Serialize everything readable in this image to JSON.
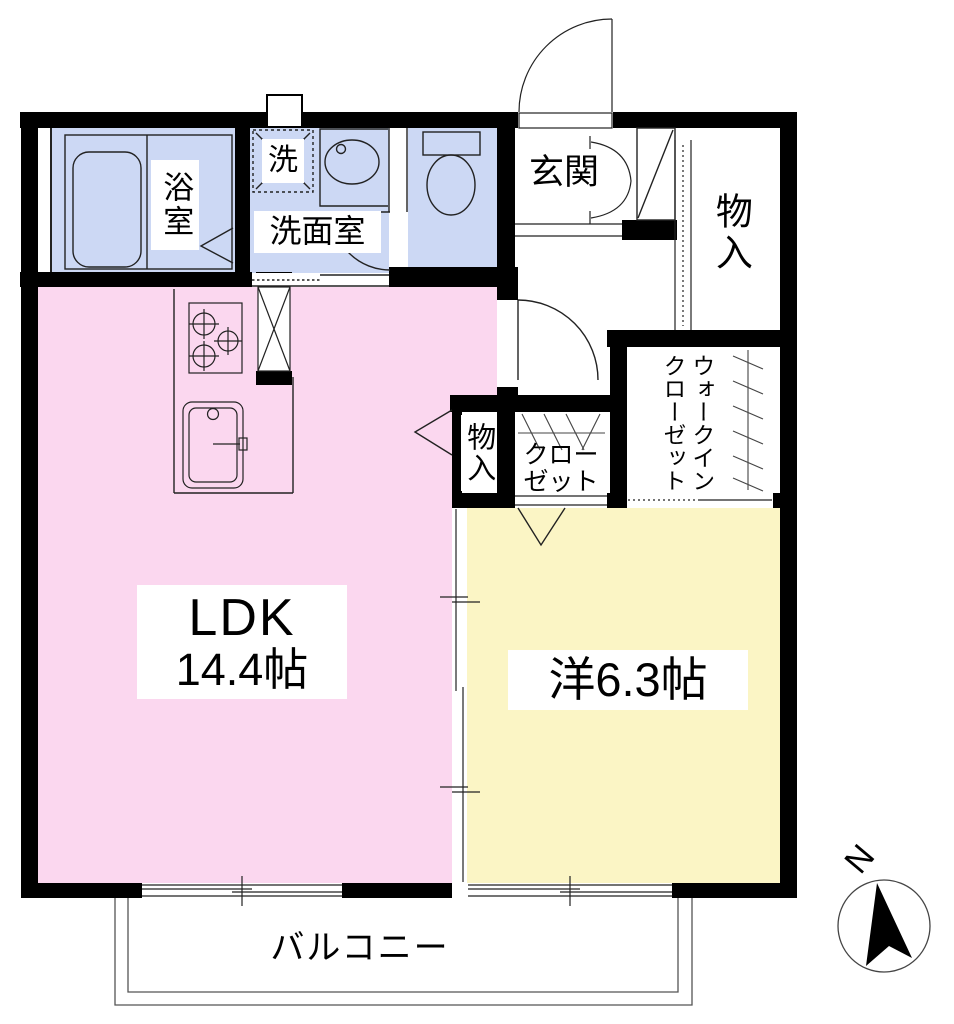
{
  "title": "floor-plan",
  "rooms": {
    "bathroom": {
      "label": "浴室"
    },
    "washer": {
      "label": "洗"
    },
    "washroom": {
      "label": "洗面室"
    },
    "toilet": {
      "label": ""
    },
    "entrance": {
      "label": "玄関"
    },
    "storage_top": {
      "label": "物入"
    },
    "storage_mid": {
      "label": "物入"
    },
    "closet": {
      "label": "クローゼット"
    },
    "walkin_closet": {
      "label": "ウォークインクローゼット"
    },
    "ldk": {
      "name": "LDK",
      "size": "14.4帖"
    },
    "western_room": {
      "label": "洋6.3帖"
    },
    "balcony": {
      "label": "バルコニー"
    }
  },
  "compass": {
    "label": "N"
  },
  "colors": {
    "wall": "#000000",
    "line": "#222222",
    "wet_area": "#ccd8f4",
    "ldk_pink": "#fbd7ef",
    "western_yellow": "#fbf5c5"
  }
}
